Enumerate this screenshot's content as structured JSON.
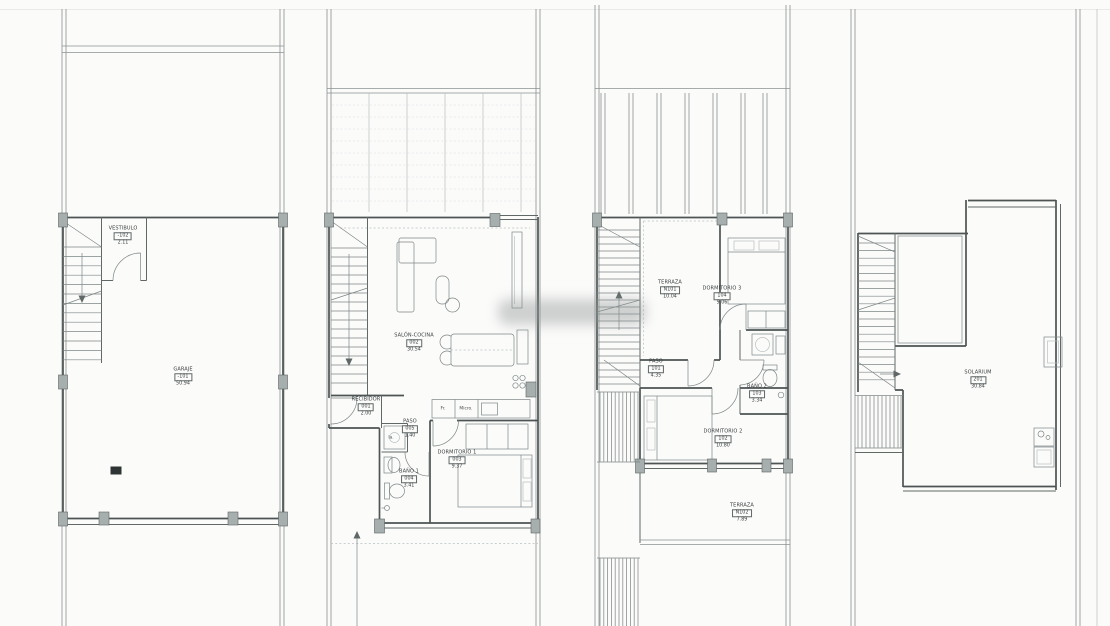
{
  "document": {
    "type": "architectural-floor-plans",
    "sheet_description": "Four stacked dwelling floor plans: basement garage, ground floor, first floor, roof solarium"
  },
  "colors": {
    "bg": "#fbfbfa",
    "wall": "#4d5454",
    "medium": "#5f6767",
    "plot": "#8a9191",
    "thin": "#7d8686",
    "faint": "#b9c1c1",
    "vfaint": "#d5dbda",
    "pillar": "#a6aeae",
    "pillarStroke": "#5c6363",
    "text": "#3a3f3f",
    "watermark": "#8f9595"
  },
  "plans": [
    {
      "id": "plan-basement",
      "title": "Planta sótano / garaje",
      "rooms": [
        {
          "name": "VESTIBULO",
          "code": "-102",
          "area": "2.11"
        },
        {
          "name": "GARAJE",
          "code": "-101",
          "area": "50.94"
        }
      ]
    },
    {
      "id": "plan-ground",
      "title": "Planta baja",
      "rooms": [
        {
          "name": "RECIBIDOR",
          "code": "001",
          "area": "2.00"
        },
        {
          "name": "SALÓN-COCINA",
          "code": "002",
          "area": "30.54"
        },
        {
          "name": "DORMITORIO 1",
          "code": "003",
          "area": "9.37"
        },
        {
          "name": "BAÑO 1",
          "code": "004",
          "area": "3.41"
        },
        {
          "name": "PASO",
          "code": "005",
          "area": "1.40"
        }
      ],
      "equipment": [
        {
          "label": "Fr."
        },
        {
          "label": "Micro."
        },
        {
          "label": "la."
        }
      ]
    },
    {
      "id": "plan-first",
      "title": "Planta primera",
      "rooms": [
        {
          "name": "PASO",
          "code": "101",
          "area": "4.35"
        },
        {
          "name": "DORMITORIO 2",
          "code": "102",
          "area": "10.80"
        },
        {
          "name": "BAÑO 2",
          "code": "103",
          "area": "3.34"
        },
        {
          "name": "DORMITORIO 3",
          "code": "104",
          "area": "9.06"
        },
        {
          "name": "TERRAZA",
          "code": "N101",
          "area": "10.04"
        },
        {
          "name": "TERRAZA",
          "code": "N102",
          "area": "7.89"
        }
      ]
    },
    {
      "id": "plan-roof",
      "title": "Planta cubierta",
      "rooms": [
        {
          "name": "SOLARIUM",
          "code": "201",
          "area": "30.84"
        }
      ]
    }
  ]
}
